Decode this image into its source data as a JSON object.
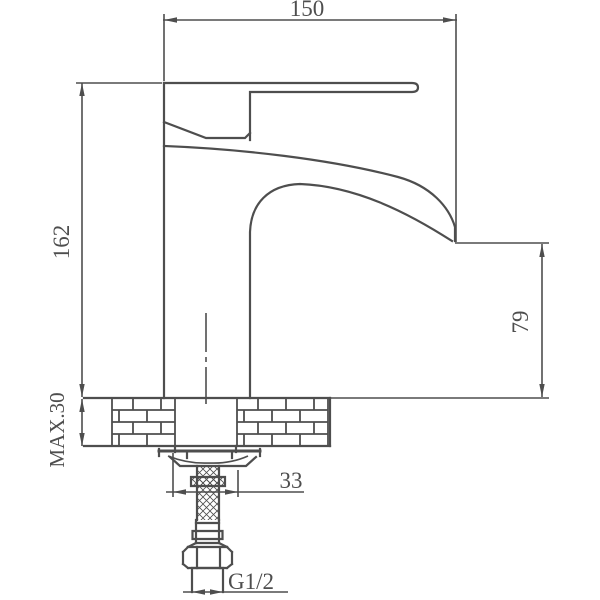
{
  "page": {
    "background": "#ffffff",
    "line_color": "#4e4e4e"
  },
  "drawing": {
    "type": "technical-drawing",
    "subject": "single-lever basin mixer faucet, side elevation with installation section",
    "labels": {
      "overall_length": "150",
      "overall_height": "162",
      "spout_outlet_height": "79",
      "max_deck_thickness": "MAX.30",
      "shank_assembly_width": "33",
      "thread_size": "G1/2"
    }
  }
}
